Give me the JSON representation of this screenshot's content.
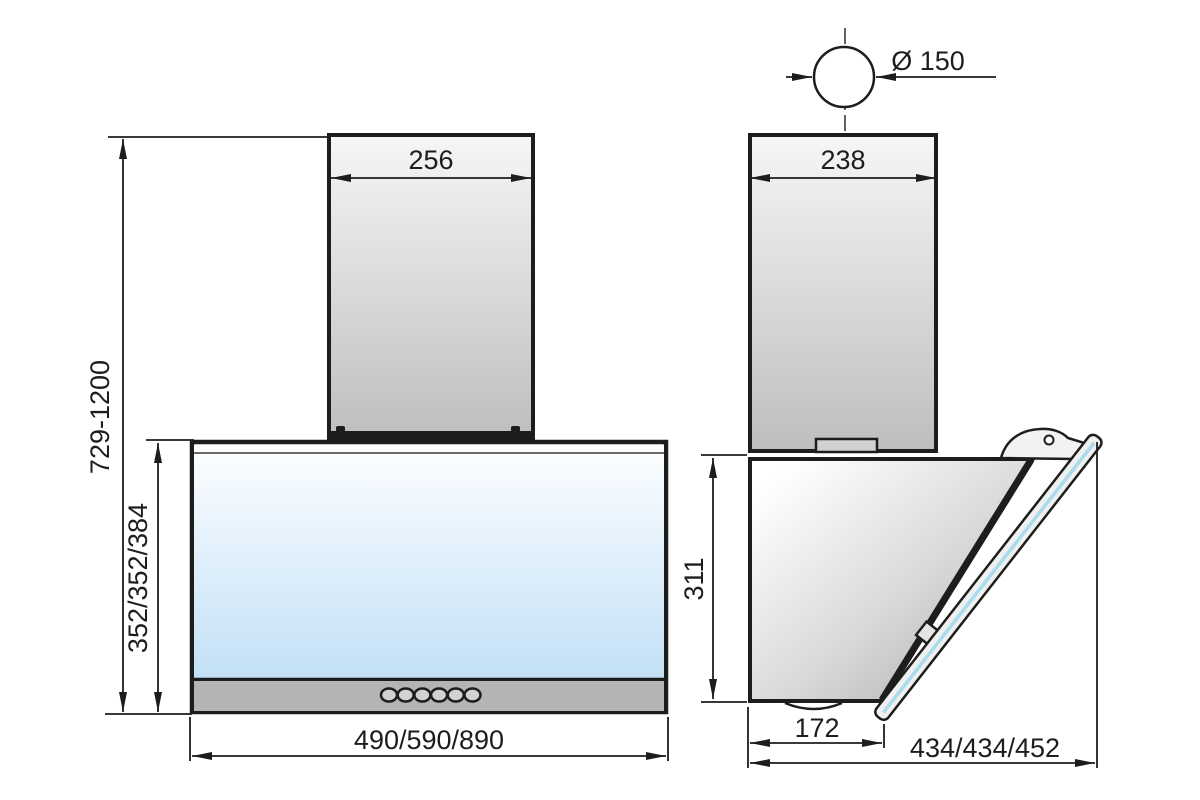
{
  "front_view": {
    "chimney_width": "256",
    "total_height_range": "729-1200",
    "body_height": "352/352/384",
    "body_width": "490/590/890"
  },
  "side_view": {
    "duct_diameter": "Ø 150",
    "chimney_depth": "238",
    "body_height": "311",
    "body_bottom_depth": "172",
    "total_depth": "434/434/452"
  },
  "colors": {
    "line": "#1d1d1b",
    "glass_blue": "#c3e0f6",
    "glass_edge_cyan": "#a9dced",
    "panel_gray": "#b2b4b6"
  }
}
